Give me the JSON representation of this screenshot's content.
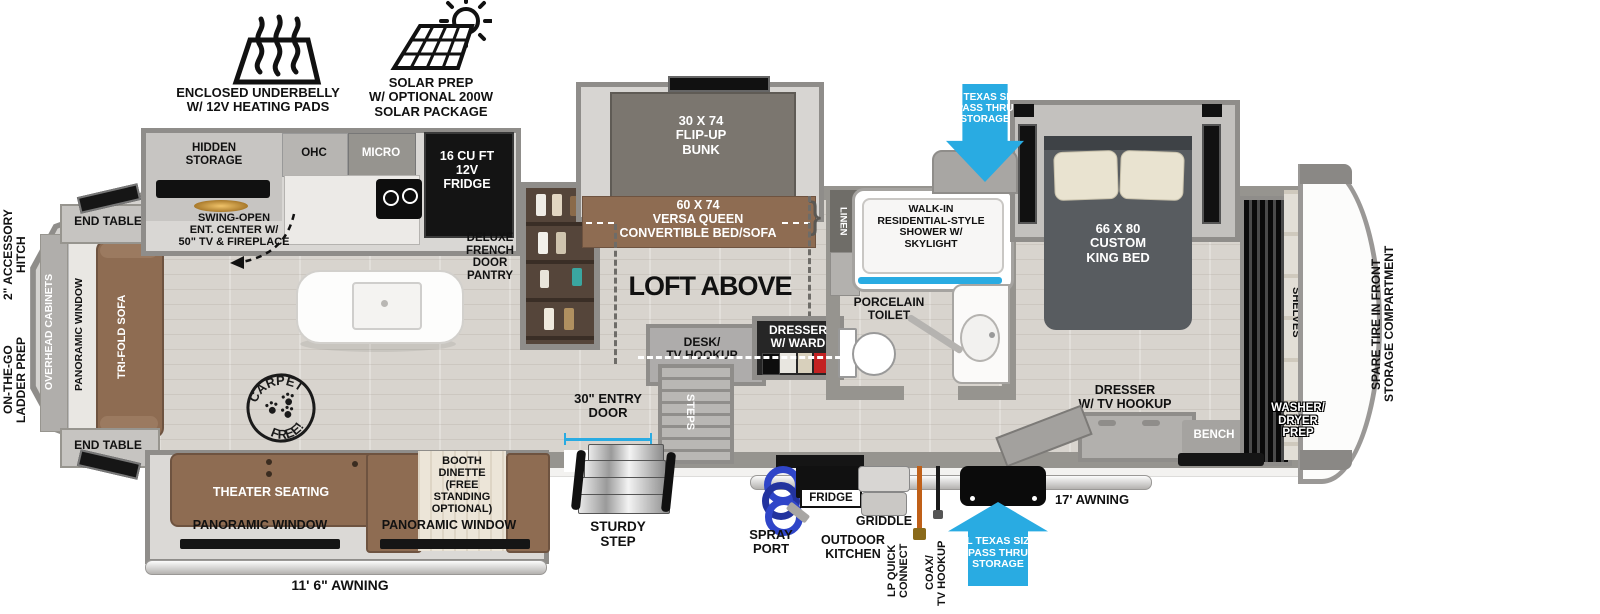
{
  "colors": {
    "accent_cyan": "#29abe2",
    "furniture_brown": "#8e6c52",
    "bed_gray": "#585c60",
    "wall_gray": "#96948f"
  },
  "callouts": {
    "underbelly": "ENCLOSED UNDERBELLY\nW/ 12V HEATING PADS",
    "solar": "SOLAR PREP\nW/ OPTIONAL 200W\nSOLAR PACKAGE"
  },
  "rear": {
    "hitch": "2\" ACCESSORY\nHITCH",
    "ladder_prep": "ON-THE-GO\nLADDER PREP",
    "end_table_top": "END TABLE",
    "end_table_bottom": "END TABLE",
    "overhead_cabinets": "OVERHEAD CABINETS",
    "panoramic_window": "PANORAMIC WINDOW",
    "trifold_sofa": "TRI-FOLD SOFA"
  },
  "kitchen": {
    "hidden_storage": "HIDDEN\nSTORAGE",
    "swing_open_ent": "SWING-OPEN\nENT. CENTER W/\n50\" TV & FIREPLACE",
    "ohc": "OHC",
    "micro": "MICRO",
    "fridge": "16 CU FT\n12V\nFRIDGE",
    "pantry": "DELUXE\nFRENCH\nDOOR\nPANTRY",
    "carpet_stamp_top": "CARPET",
    "carpet_stamp_bottom": "FREE!"
  },
  "bunk_room": {
    "flip_up_bunk": "30 X 74\nFLIP-UP\nBUNK",
    "versa_queen": "60 X 74\nVERSA QUEEN\nCONVERTIBLE BED/SOFA",
    "brace": "}",
    "loft_above": "LOFT ABOVE",
    "desk": "DESK/\nTV HOOKUP",
    "dresser_ward": "DRESSER\nW/ WARD",
    "steps": "STEPS"
  },
  "bathroom": {
    "linen": "LINEN",
    "shower": "WALK-IN\nRESIDENTIAL-STYLE\nSHOWER W/\nSKYLIGHT",
    "toilet": "PORCELAIN\nTOILET"
  },
  "bedroom": {
    "pass_thru_top": "XL TEXAS SIZE\nPASS THRU\nSTORAGE",
    "king_bed": "66 X 80\nCUSTOM\nKING BED",
    "dresser_tv": "DRESSER\nW/ TV HOOKUP",
    "bench": "BENCH",
    "shelves": "SHELVES",
    "washer_dryer": "WASHER/\nDRYER\nPREP",
    "spare_tire": "SPARE TIRE IN FRONT\nSTORAGE COMPARTMENT"
  },
  "bottom_slide": {
    "theater_seating": "THEATER SEATING",
    "panoramic_window_left": "PANORAMIC WINDOW",
    "panoramic_window_right": "PANORAMIC WINDOW",
    "booth_dinette": "BOOTH\nDINETTE\n(FREE\nSTANDING\nOPTIONAL)",
    "awning": "11' 6\" AWNING"
  },
  "exterior": {
    "entry_door": "30\" ENTRY\nDOOR",
    "sturdy_step": "STURDY\nSTEP",
    "spray_port": "SPRAY\nPORT",
    "outdoor_fridge": "FRIDGE",
    "griddle": "GRIDDLE",
    "outdoor_kitchen": "OUTDOOR\nKITCHEN",
    "lp_quick_connect": "LP QUICK\nCONNECT",
    "coax_tv": "COAX/\nTV HOOKUP",
    "pass_thru_bottom": "XL TEXAS SIZE\nPASS THRU\nSTORAGE",
    "awning": "17' AWNING"
  }
}
